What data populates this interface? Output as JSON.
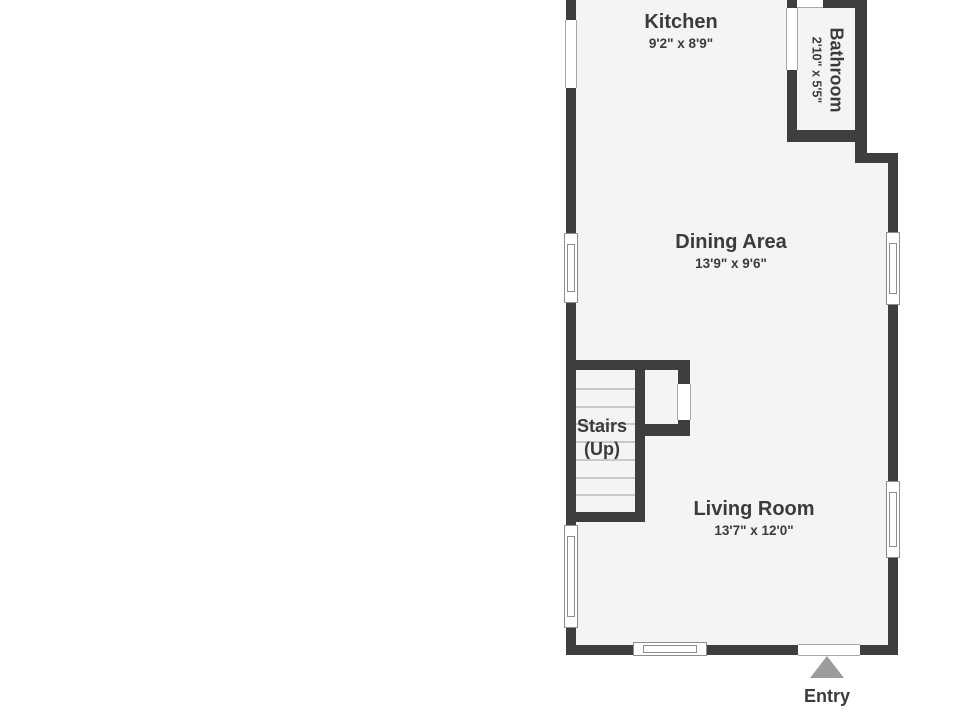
{
  "colors": {
    "wall": "#3e3e3e",
    "floor": "#f4f4f4",
    "outside": "#ffffff",
    "text": "#3b3b3b",
    "entry_arrow": "#9c9c9c",
    "tread_line": "#c9c9c9",
    "window_frame": "#8e8e8e"
  },
  "rooms": {
    "kitchen": {
      "name": "Kitchen",
      "dimensions": "9'2\" x 8'9\""
    },
    "bathroom": {
      "name": "Bathroom",
      "dimensions": "2'10\" x 5'5\""
    },
    "dining": {
      "name": "Dining Area",
      "dimensions": "13'9\" x 9'6\""
    },
    "living": {
      "name": "Living Room",
      "dimensions": "13'7\" x 12'0\""
    }
  },
  "stairs": {
    "line1": "Stairs",
    "line2": "(Up)",
    "tread_count": 7
  },
  "entry": {
    "label": "Entry"
  }
}
